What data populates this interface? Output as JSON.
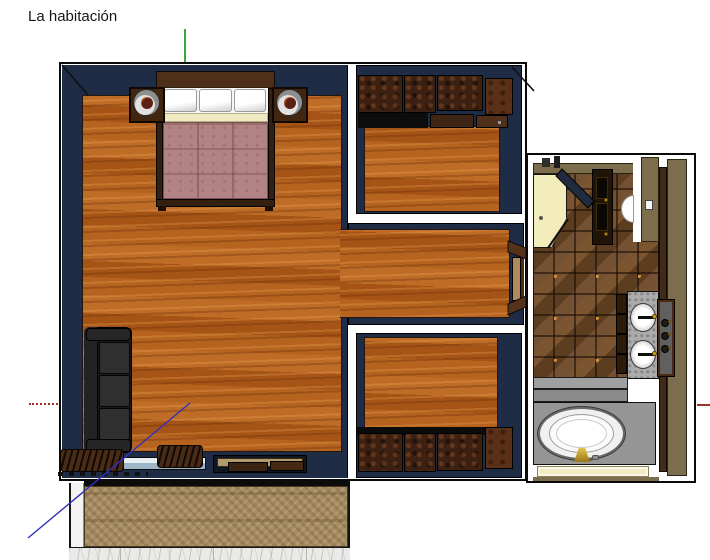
{
  "title": "La habitación",
  "palette": {
    "background": "#ffffff",
    "outline": "#0a0a0a",
    "wall": "#1f2c46",
    "wood": "#b2601f",
    "cabinet": "#3c2113",
    "cabinet_light": "#5a3118",
    "bed_frame": "#33200f",
    "headboard": "#4e301a",
    "spread": "#b18384",
    "sheet": "#f1e9c2",
    "sofa": "#1c1c1c",
    "tile": "#6b4a2c",
    "shower": "#f3edbc",
    "olive": "#7c6e4c",
    "wall_brown": "#3f2b17",
    "counter": "#ababab",
    "platform": "#959595",
    "mat": "#f2ecc2",
    "carpet": "#a78c62",
    "marble": "#eaeae8",
    "gold": "#c9a22a",
    "axis_green": "#3fa33f",
    "axis_red": "#a03028",
    "axis_blue": "#2f2fbf"
  }
}
